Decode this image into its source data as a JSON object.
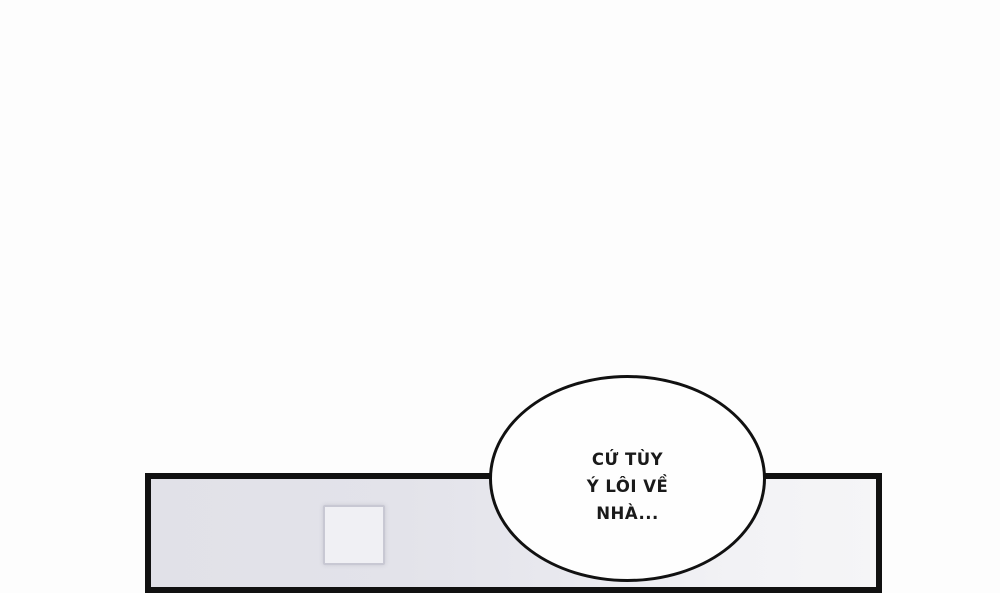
{
  "page": {
    "type": "comic-page-segment",
    "background_color": "#fdfdfd"
  },
  "colors": {
    "ink": "#111111",
    "panel_wall_left": "#e2e2e9",
    "panel_wall_right": "#f4f4f6",
    "door_fill": "#f0f0f4",
    "door_border": "#c8c8d3",
    "bubble_fill": "#fefefe"
  },
  "speech_bubble": {
    "full_text": "CỨ TÙY Ý LÔI VỀ NHÀ...",
    "lines": [
      "CỨ TÙY",
      "Ý LÔI VỀ",
      "NHÀ..."
    ]
  }
}
